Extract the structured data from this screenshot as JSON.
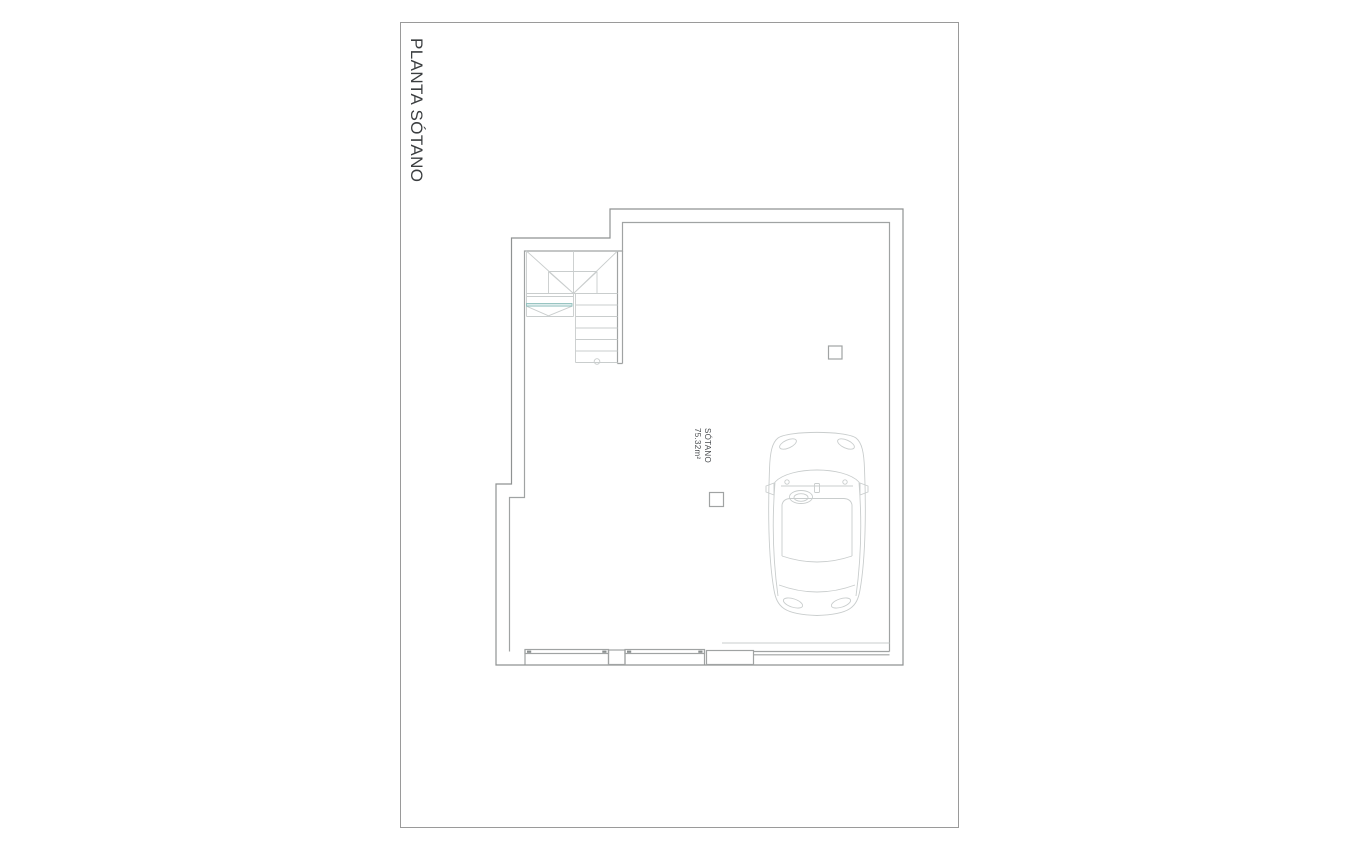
{
  "page": {
    "title": "PLANTA SÓTANO"
  },
  "room": {
    "name": "SÓTANO",
    "area": "75.32m²"
  },
  "icons": {
    "car": "car-top-view-icon",
    "stairs": "staircase-icon",
    "column": "structural-column-marker",
    "window": "window-symbol",
    "garage_door": "garage-door-symbol"
  },
  "colors": {
    "page_border": "#9a9a9a",
    "wall": "#a0a3a3",
    "wall_dark": "#8f9292",
    "detail": "#c9cdcd",
    "accent": "#8fc0bd",
    "accent_fill": "#ddecec",
    "title_text": "#3b3e40",
    "label_text": "#4a4d50",
    "background": "#ffffff"
  }
}
